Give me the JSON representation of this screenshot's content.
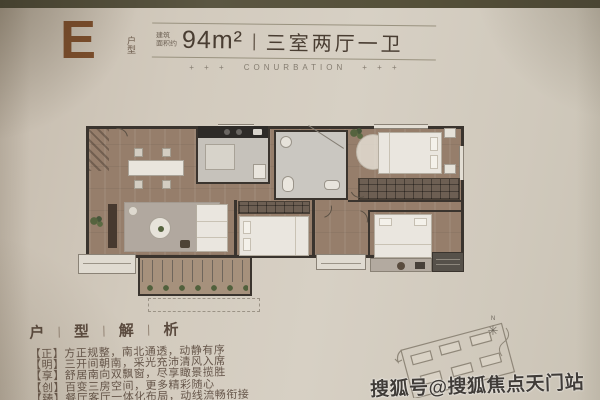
{
  "header": {
    "unit_letter": "E",
    "unit_label_top": "户",
    "unit_label_bottom": "型",
    "area_prefix_top": "建筑",
    "area_prefix_bottom": "面积约",
    "area_value": "94m²",
    "divider": "|",
    "layout_text": "三室两厅一卫",
    "deco_left": "+ + +",
    "deco_word": "CONURBATION",
    "deco_right": "+ + +"
  },
  "analysis": {
    "title": [
      "户",
      "型",
      "解",
      "析"
    ],
    "title_separator": "|",
    "lines": [
      "【正】方正规整，南北通透，动静有序",
      "【明】三开间朝南，采光充沛清风入席",
      "【享】舒居南向双飘窗，尽享瞰景揽胜",
      "【创】百变三房空间，更多精彩随心",
      "【臻】餐厅客厅一体化布局，动线流畅衔接"
    ]
  },
  "compass": {
    "north_label": "N",
    "star_glyph": "✳"
  },
  "watermark": {
    "text": "搜狐号@搜狐焦点天门站"
  },
  "colors": {
    "accent_brown": "#7d4e2c",
    "text_sepia": "#493d32",
    "wall_dark": "#3a342e",
    "wood_floor": "#967e6b",
    "rug_gray": "#b1a89f",
    "plant_green": "#55633e",
    "page_beige": "#d2cabd"
  }
}
